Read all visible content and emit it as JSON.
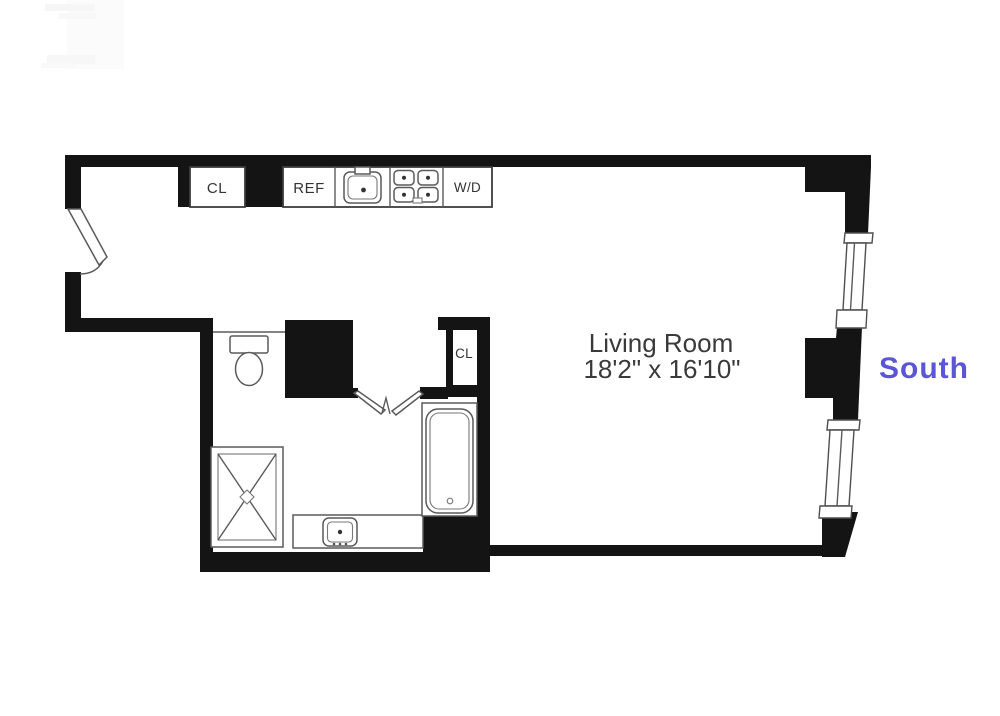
{
  "floorplan": {
    "orientation_label": "South",
    "entry_closet_label": "CL",
    "kitchen": {
      "refrigerator_label": "REF",
      "washer_dryer_label": "W/D"
    },
    "bathroom": {
      "closet_label": "CL"
    },
    "living_room": {
      "name": "Living Room",
      "dimensions": "18'2\" x 16'10\""
    },
    "colors": {
      "wall": "#141414",
      "fixture_line": "#5a5a5a",
      "label_text": "#333333",
      "south_accent": "#5a56d6"
    }
  }
}
